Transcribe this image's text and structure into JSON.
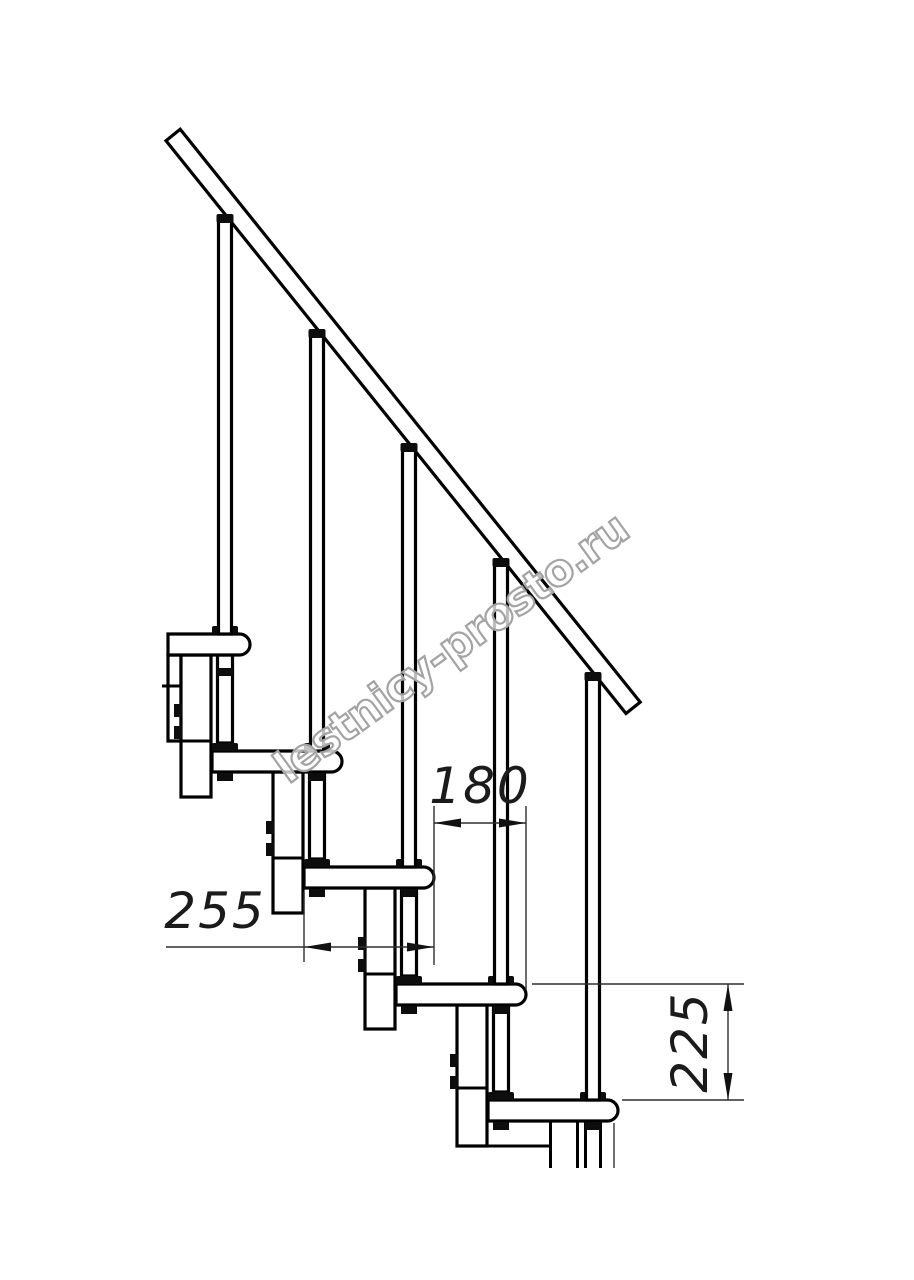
{
  "drawing": {
    "type": "staircase-side-view-technical-drawing",
    "steps_visible": 5,
    "dimensions": {
      "offset": {
        "label": "180"
      },
      "depth": {
        "label": "255"
      },
      "rise": {
        "label": "225"
      }
    },
    "watermark": {
      "text": "lestnicy-prosto.ru"
    },
    "colors": {
      "line": "#000000",
      "dimension_line": "#2e2e2e",
      "dimension_text": "#1b1b1b",
      "watermark": "#a3a3a3",
      "background": "#ffffff"
    }
  }
}
